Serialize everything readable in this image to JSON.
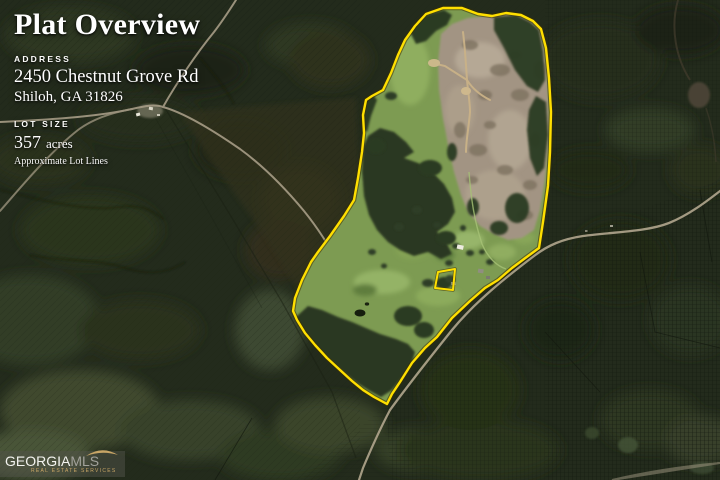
{
  "page": {
    "width": 720,
    "height": 480
  },
  "header": {
    "title": "Plat Overview",
    "address": {
      "label": "ADDRESS",
      "line1": "2450 Chestnut Grove Rd",
      "line2": "Shiloh, GA 31826"
    },
    "lot": {
      "label": "LOT SIZE",
      "value": "357",
      "unit": "acres",
      "note": "Approximate Lot Lines"
    }
  },
  "map": {
    "boundary_color": "#ffdf00",
    "boundary_points": "426,14 443,8 462,8 478,14 492,16 506,13 521,15 533,21 541,29 546,48 549,78 551,112 550,152 548,186 543,222 539,248 524,259 512,268 498,280 485,288 470,301 452,318 437,337 425,348 412,363 400,382 392,394 387,404 374,397 363,390 352,381 340,370 327,358 315,345 305,333 297,320 293,311 295,298 302,280 311,262 318,252 330,236 344,216 354,200 358,178 362,152 364,133 363,115 366,100 372,96 383,90 391,73 398,55 405,40 415,26",
    "exclusion_points": "435,288 438,272 455,269 453,290"
  },
  "logo": {
    "part1": "GEORGIA",
    "part2": "MLS",
    "tagline": "REAL ESTATE SERVICES"
  }
}
